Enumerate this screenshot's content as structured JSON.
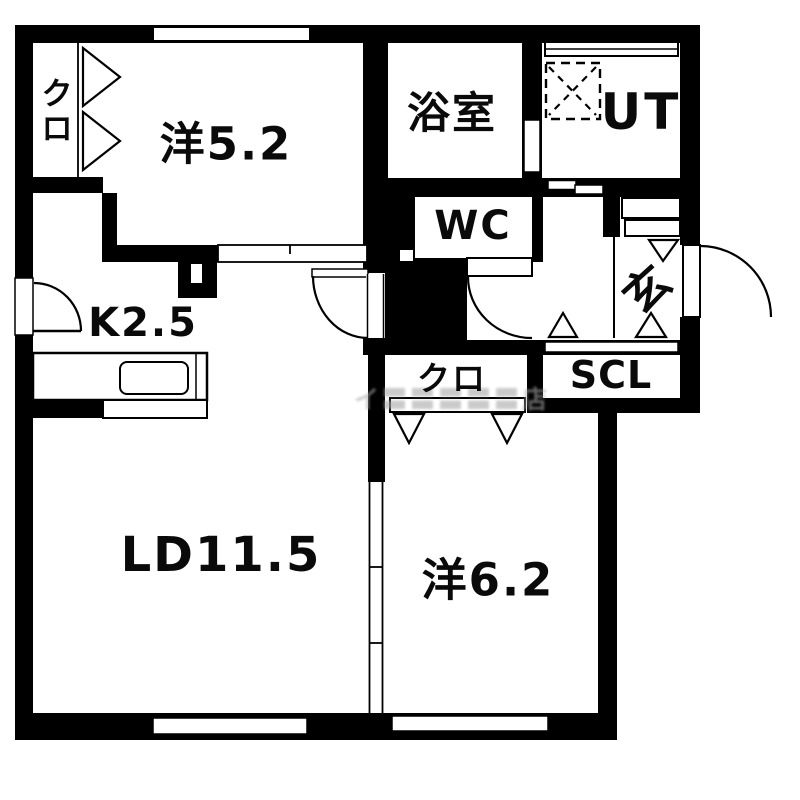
{
  "floorplan": {
    "labels": {
      "west_bedroom": "洋5.2",
      "closet_west": "クロ",
      "bathroom": "浴室",
      "utility": "UT",
      "wc": "WC",
      "entrance": "玄",
      "kitchen": "K2.5",
      "closet_mid": "クロ",
      "shoe_closet": "SCL",
      "living_dining": "LD11.5",
      "east_bedroom": "洋6.2"
    },
    "watermark": "イ〓〓〓〓〓店",
    "colors": {
      "wall": "#000000",
      "floor": "#ffffff",
      "watermark": "#a8a8a8"
    }
  }
}
